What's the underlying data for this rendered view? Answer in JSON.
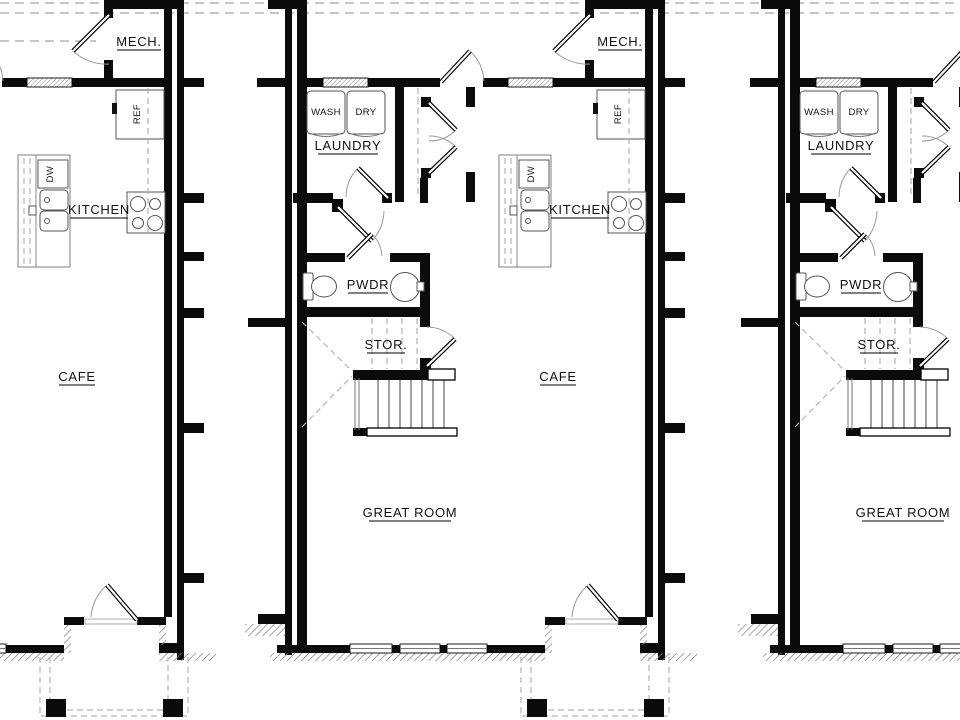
{
  "plan": {
    "room_labels": {
      "mech": "MECH.",
      "kitchen": "KITCHEN",
      "cafe": "CAFE",
      "laundry": "LAUNDRY",
      "powder": "PWDR",
      "storage": "STOR.",
      "great_room": "GREAT ROOM"
    },
    "appliance_labels": {
      "washer": "WASH",
      "dryer": "DRY",
      "refrigerator": "REF",
      "dishwasher": "DW"
    },
    "colors": {
      "walls": "#0b0b0b",
      "thin_lines": "#777777",
      "dashed_lines": "#b5b5b5",
      "background": "#ffffff"
    }
  }
}
